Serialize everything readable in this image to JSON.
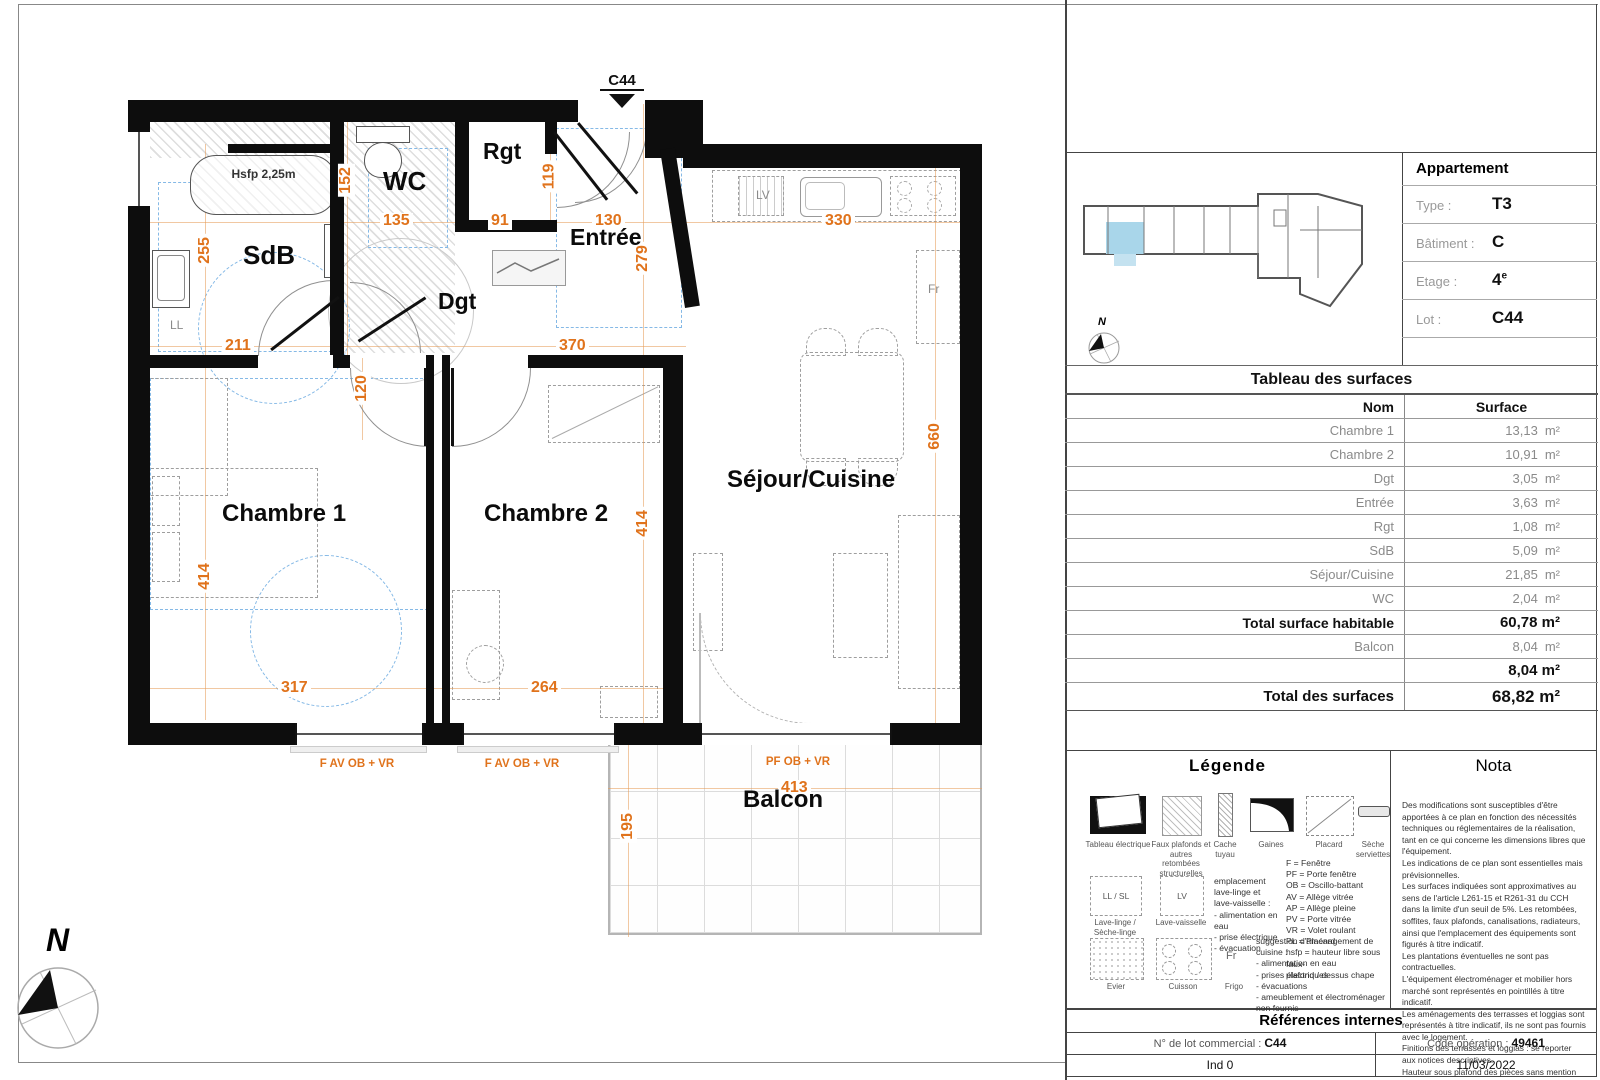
{
  "plan": {
    "lot_marker": "C44",
    "north": "N",
    "rooms": {
      "sdb": "SdB",
      "wc": "WC",
      "rgt": "Rgt",
      "entree": "Entrée",
      "dgt": "Dgt",
      "ch1": "Chambre 1",
      "ch2": "Chambre 2",
      "sejour": "Séjour/Cuisine",
      "balcon": "Balcon"
    },
    "labels": {
      "hsfp": "Hsfp 2,25m",
      "ll": "LL",
      "lv": "LV",
      "fr": "Fr"
    },
    "dims": {
      "d152": "152",
      "d135": "135",
      "d91": "91",
      "d119": "119",
      "d130": "130",
      "d279": "279",
      "d330": "330",
      "d255": "255",
      "d211": "211",
      "d120": "120",
      "d370": "370",
      "d414a": "414",
      "d414b": "414",
      "d317": "317",
      "d264": "264",
      "d660": "660",
      "d413": "413",
      "d195": "195"
    },
    "windows": {
      "w1": "F AV OB + VR",
      "w2": "F AV OB + VR",
      "w3": "PF OB + VR"
    }
  },
  "panel": {
    "apartment": {
      "title": "Appartement",
      "type_label": "Type :",
      "type_value": "T3",
      "bat_label": "Bâtiment :",
      "bat_value": "C",
      "etage_label": "Etage :",
      "etage_value": "4",
      "etage_sup": "e",
      "lot_label": "Lot :",
      "lot_value": "C44",
      "north": "N"
    },
    "surfaces": {
      "title": "Tableau des surfaces",
      "col_name": "Nom",
      "col_surface": "Surface",
      "unit": "m²",
      "rows": [
        {
          "name": "Chambre 1",
          "value": "13,13"
        },
        {
          "name": "Chambre 2",
          "value": "10,91"
        },
        {
          "name": "Dgt",
          "value": "3,05"
        },
        {
          "name": "Entrée",
          "value": "3,63"
        },
        {
          "name": "Rgt",
          "value": "1,08"
        },
        {
          "name": "SdB",
          "value": "5,09"
        },
        {
          "name": "Séjour/Cuisine",
          "value": "21,85"
        },
        {
          "name": "WC",
          "value": "2,04"
        }
      ],
      "total_hab_label": "Total surface habitable",
      "total_hab_value": "60,78 m²",
      "balcon_label": "Balcon",
      "balcon_value": "8,04",
      "balcon_total": "8,04 m²",
      "total_label": "Total des surfaces",
      "total_value": "68,82 m²"
    },
    "legend": {
      "title": "Légende",
      "items": {
        "i1": "Tableau électrique",
        "i2": "Faux plafonds et autres retombées structurelles",
        "i3": "Cache tuyau",
        "i4": "Gaines",
        "i5": "Placard",
        "i6": "Sèche serviettes"
      },
      "abbreviations": "F = Fenêtre\nPF = Porte fenêtre\nOB = Oscillo-battant\nAV = Allège vitrée\nAP = Allège pleine\nPV = Porte vitrée\nVR = Volet roulant\nPL = Placard\nhsfp = hauteur libre sous faux-\nplafond / dessus chape",
      "ll_box": "LL / SL",
      "ll_label": "Lave-linge /\nSèche-linge",
      "lv_box": "LV",
      "lv_label": "Lave-vaisselle",
      "washer_note": "emplacement lave-linge et\nlave-vaisselle :\n- alimentation en eau\n- prise électrique\n- évacuation",
      "evier_label": "Evier",
      "cuisson_label": "Cuisson",
      "frigo_box": "Fr",
      "frigo_label": "Frigo",
      "kitchen_note": "suggestion d'aménagement de cuisine :\n- alimentation en eau\n- prises électriques\n- évacuations\n- ameublement et électroménager non fournis"
    },
    "nota": {
      "title": "Nota",
      "text": "Des modifications sont susceptibles d'être apportées à ce plan en fonction des nécessités techniques ou réglementaires de la réalisation, tant en ce qui concerne les dimensions libres que l'équipement.\nLes indications de ce plan sont essentielles mais prévisionnelles.\nLes surfaces indiquées sont approximatives au sens de l'article L261-15 et R261-31 du CCH dans la limite d'un seuil de 5%. Les retombées, soffites, faux plafonds, canalisations, radiateurs, ainsi que l'emplacement des équipements sont figurés à titre indicatif.\nLes plantations éventuelles ne sont pas contractuelles.\nL'équipement électroménager et mobilier hors marché sont représentés en pointillés à titre indicatif.\nLes aménagements des terrasses et loggias sont représentés à titre indicatif, ils ne sont pas fournis avec le logement.\nFinitions des terrasses et loggias : se reporter aux notices descriptives.\nHauteur sous plafond des pièces sans mention particulière 2,45m."
    },
    "references": {
      "title": "Références internes",
      "lot_label": "N° de lot commercial :",
      "lot_value": "C44",
      "code_label": "Code opération :",
      "code_value": "49461",
      "ind": "Ind 0",
      "date": "11/03/2022"
    }
  },
  "colors": {
    "dimension_orange": "#E0731C",
    "hsfp_blue": "#85B9E6",
    "wall": "#0D0D0D",
    "unit_highlight": "#A9D6EA"
  }
}
